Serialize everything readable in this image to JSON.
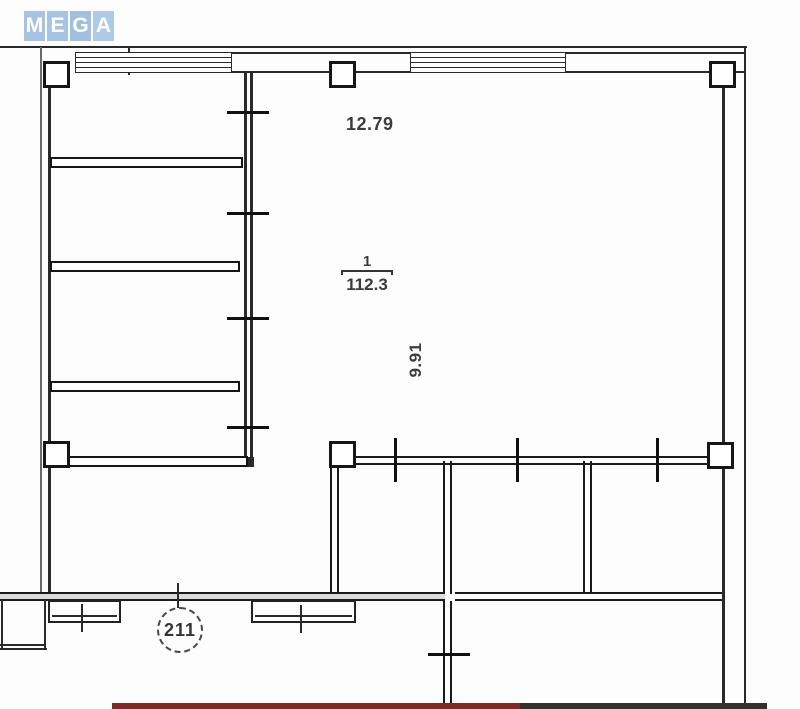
{
  "watermark": {
    "name": "MEGA",
    "letters": [
      "M",
      "E",
      "G",
      "A"
    ],
    "tile_color": "#a6c4e1",
    "letter_color": "#ffffff"
  },
  "plan": {
    "room": {
      "number": "1",
      "area": "112.3"
    },
    "dimensions": {
      "width": "12.79",
      "depth": "9.91"
    },
    "unit_badge": "211"
  },
  "colors": {
    "wall_line": "#1a1a1a",
    "scan_band_red": "#7b2a28",
    "scan_band_dark": "#35302e",
    "logo_blue": "#a6c4e1"
  }
}
